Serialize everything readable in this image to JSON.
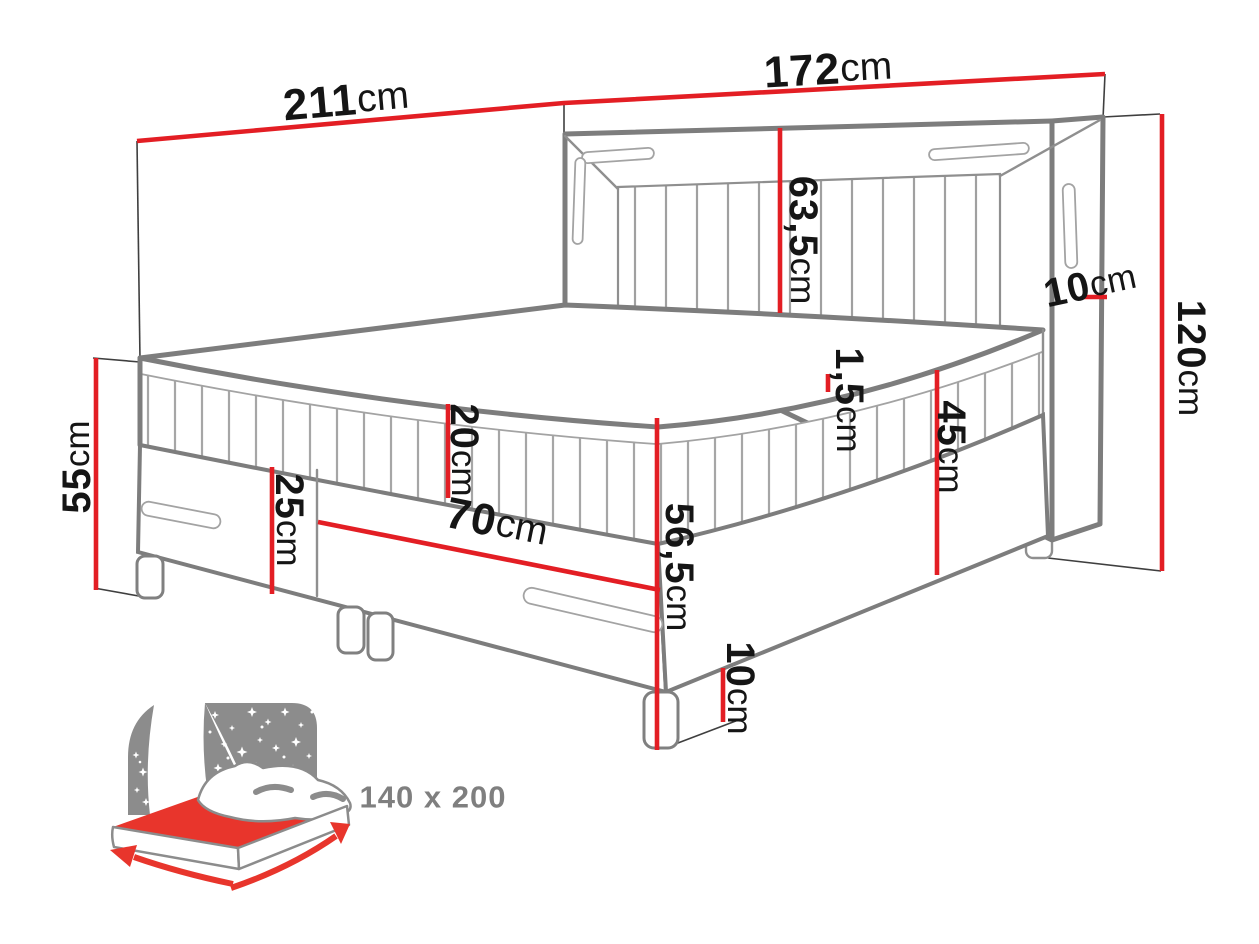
{
  "page": {
    "type": "bed-dimension-diagram",
    "background": "#ffffff"
  },
  "dimensions": {
    "total_width": {
      "value": "211",
      "unit": "cm"
    },
    "headboard_width": {
      "value": "172",
      "unit": "cm"
    },
    "headboard_above_mattress": {
      "value": "63,5",
      "unit": "cm"
    },
    "headboard_depth": {
      "value": "10",
      "unit": "cm"
    },
    "headboard_height": {
      "value": "120",
      "unit": "cm"
    },
    "left_side_height": {
      "value": "55",
      "unit": "cm"
    },
    "mattress_height": {
      "value": "20",
      "unit": "cm"
    },
    "base_height": {
      "value": "25",
      "unit": "cm"
    },
    "base_half_width": {
      "value": "70",
      "unit": "cm"
    },
    "topper_height": {
      "value": "1,5",
      "unit": "cm"
    },
    "mattress_base_height": {
      "value": "45",
      "unit": "cm"
    },
    "corner_height": {
      "value": "56,5",
      "unit": "cm"
    },
    "leg_height": {
      "value": "10",
      "unit": "cm"
    }
  },
  "size_icon": {
    "label": "140 x 200"
  },
  "colors": {
    "dimension_red": "#e31e24",
    "icon_red": "#e8352c",
    "outline_dark_gray": "#7d7d7d",
    "outline_light_gray": "#a3a3a3",
    "icon_gray": "#8c8c8c",
    "size_label_gray": "#7f7f7f",
    "dimension_text_black": "#151515"
  }
}
